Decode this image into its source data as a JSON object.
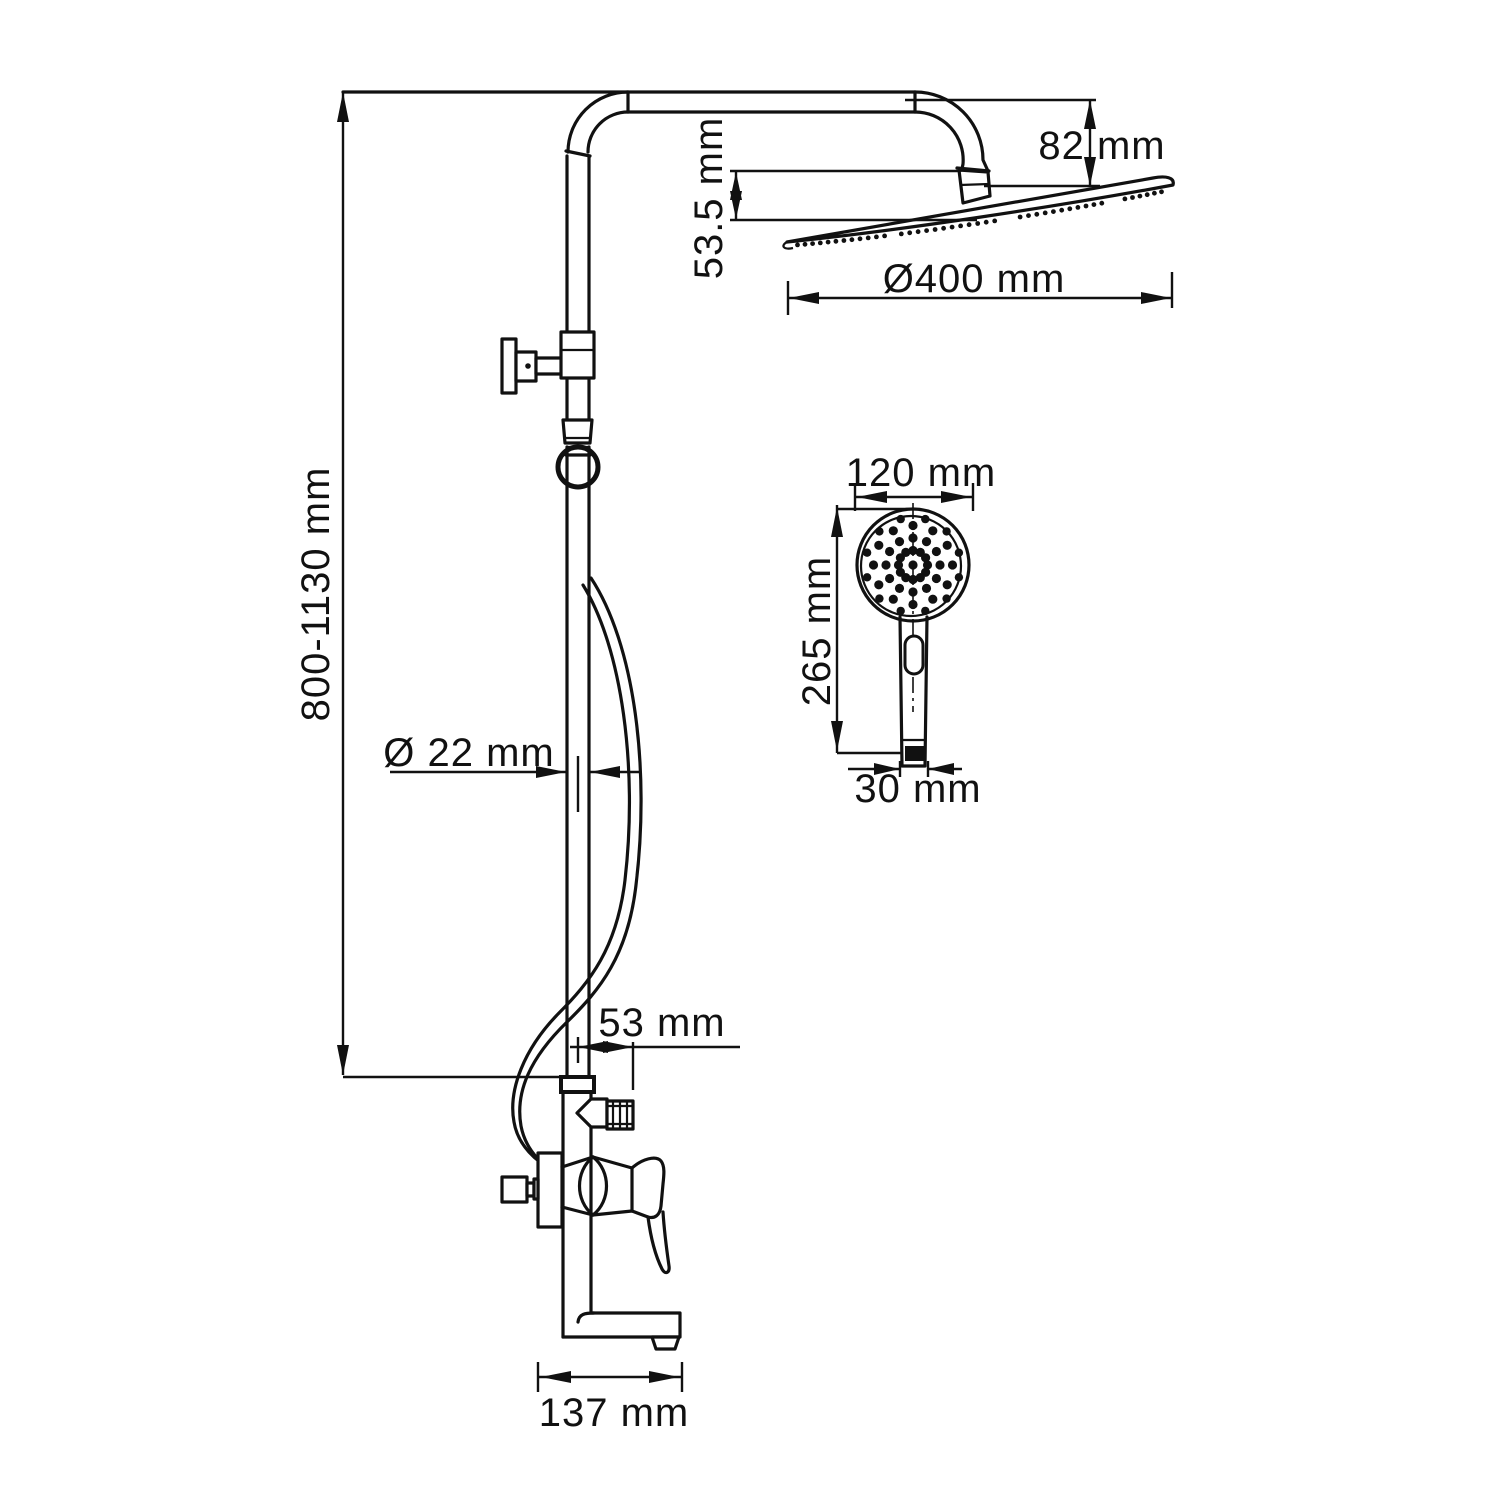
{
  "drawing": {
    "type": "technical dimension drawing",
    "subject": "wall-mounted shower column with rain head, hand shower and mixer",
    "colors": {
      "line": "#111111",
      "background": "#ffffff"
    }
  },
  "labels": {
    "column_height": "800-1130 mm",
    "head_clearance": "53.5 mm",
    "arm_drop": "82 mm",
    "head_diameter": "Ø400 mm",
    "pipe_diameter": "Ø 22 mm",
    "outlet_offset": "53 mm",
    "spout_reach": "137 mm",
    "hand_width": "120 mm",
    "hand_length": "265 mm",
    "hand_inlet": "30 mm"
  }
}
